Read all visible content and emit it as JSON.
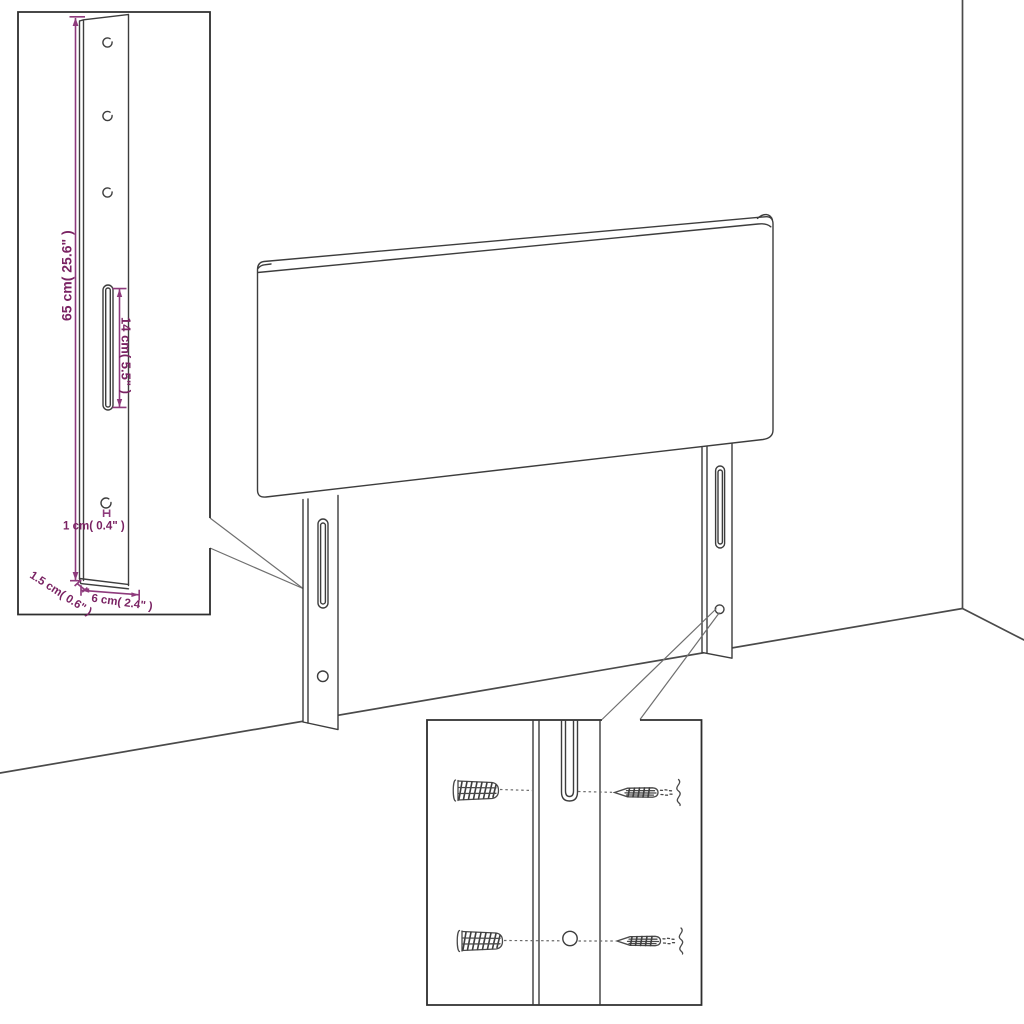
{
  "diagram": {
    "kind": "headboard assembly dimension diagram",
    "scene": [
      "room-corner",
      "headboard-with-mounting-legs",
      "bracket-detail-inset",
      "mounting-hardware-detail-inset"
    ]
  },
  "colors": {
    "background": "#ffffff",
    "artwork_line": "#3d3d3d",
    "inset_border": "#2e2e2e",
    "room_line": "#4a4a4a",
    "dimension_line": "#8e3a7c",
    "dimension_text": "#7a2363"
  },
  "bracket_detail": {
    "dimensions": {
      "height": "65 cm( 25.6\" )",
      "slot_length": "14 cm( 5.5\" )",
      "hole_diameter": "1 cm( 0.4\" )",
      "thickness": "1.5 cm( 0.6\" )",
      "width": "6 cm( 2.4\" )"
    }
  },
  "mounting_detail": {
    "parts": {
      "wall_plug": "wall-plug-icon",
      "screw": "screw-icon",
      "slot": "bracket-slot",
      "hole": "bracket-hole"
    }
  }
}
